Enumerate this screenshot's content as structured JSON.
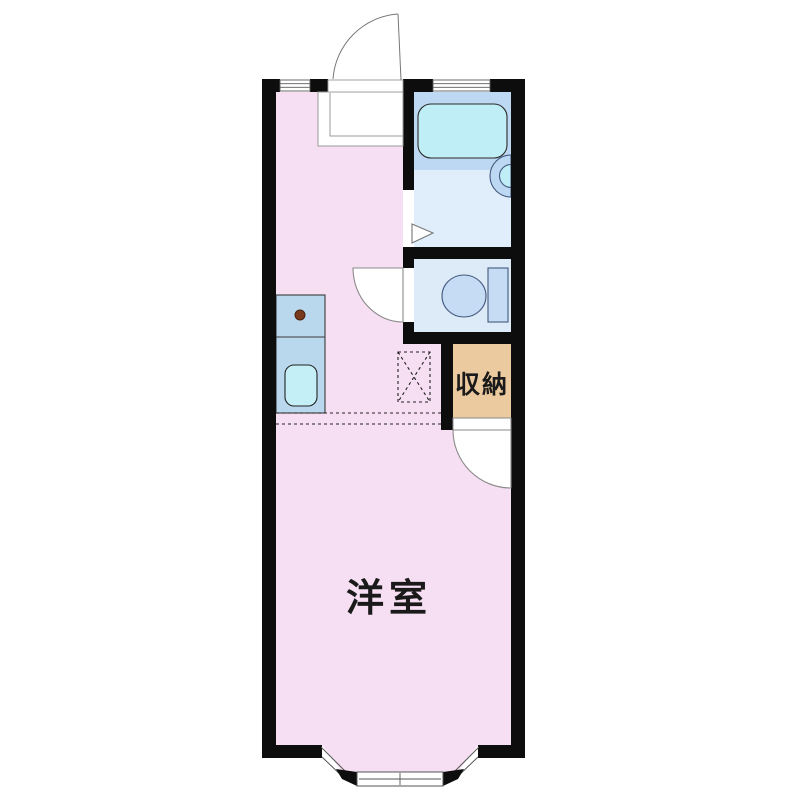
{
  "floorplan": {
    "labels": {
      "western_room": "洋室",
      "storage": "収納"
    },
    "colors": {
      "background": "#ffffff",
      "wall": "#0d0d0d",
      "room_pink": "#f6dff2",
      "bath_floor": "#dfeefa",
      "tub_deck": "#bdd8f2",
      "tub_cyan": "#c0eef6",
      "toilet_floor": "#ddebf8",
      "fixture_blue": "#c6dcf4",
      "fixture_stroke": "#44597e",
      "counter_blue": "#b9d8ee",
      "sink_cyan": "#c5eff6",
      "storage_tan": "#ecca9f",
      "burner_brown": "#7a3a1e",
      "door_line": "#777777",
      "step_line": "#999999",
      "window_line": "#5a5a5a",
      "dash_line": "#222222",
      "label_dark": "#1a1a1a"
    }
  }
}
